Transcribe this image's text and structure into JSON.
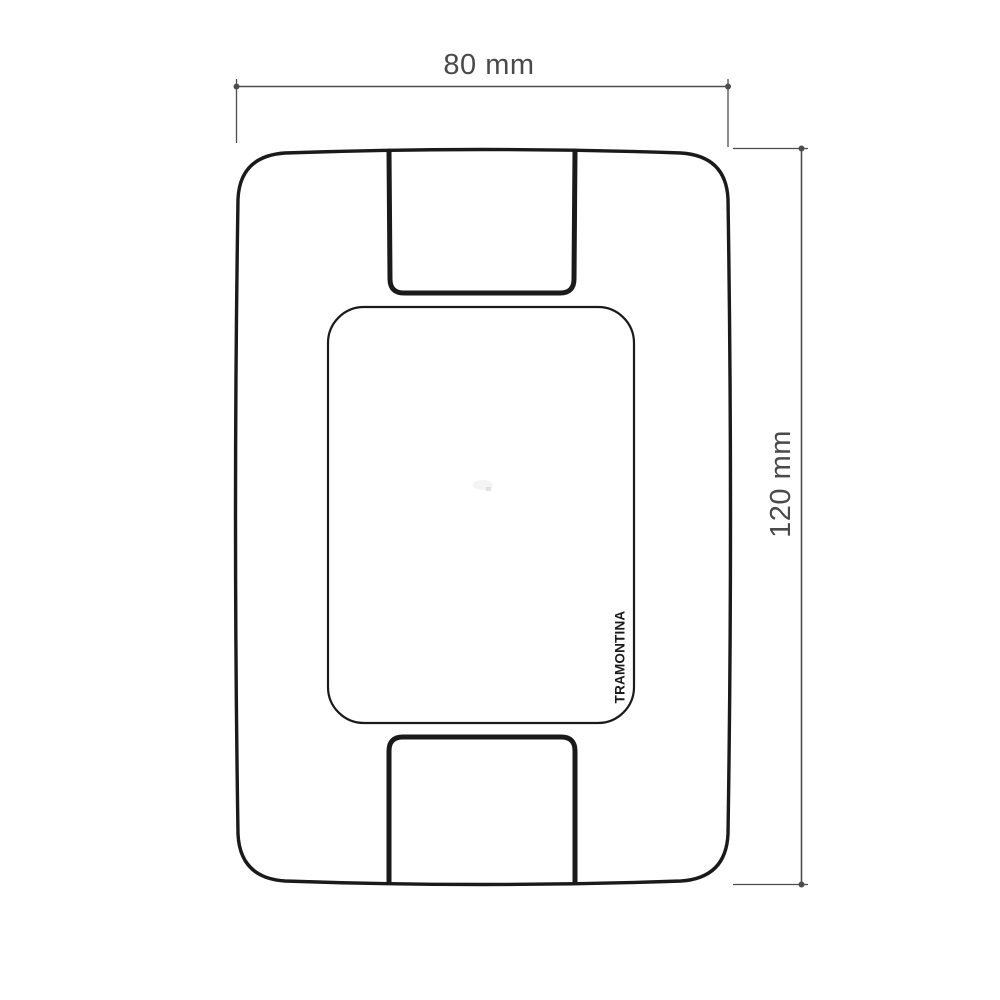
{
  "drawing": {
    "brand_label": "TRAMONTINA",
    "dimensions": {
      "width_label": "80 mm",
      "height_label": "120 mm"
    }
  },
  "icons": {
    "dimension_endpoint": "dot"
  },
  "colors": {
    "background": "#ffffff",
    "outline": "#1a1a1a",
    "dimension_line": "#4d4d4d",
    "dimension_text": "#4a4a4a"
  }
}
